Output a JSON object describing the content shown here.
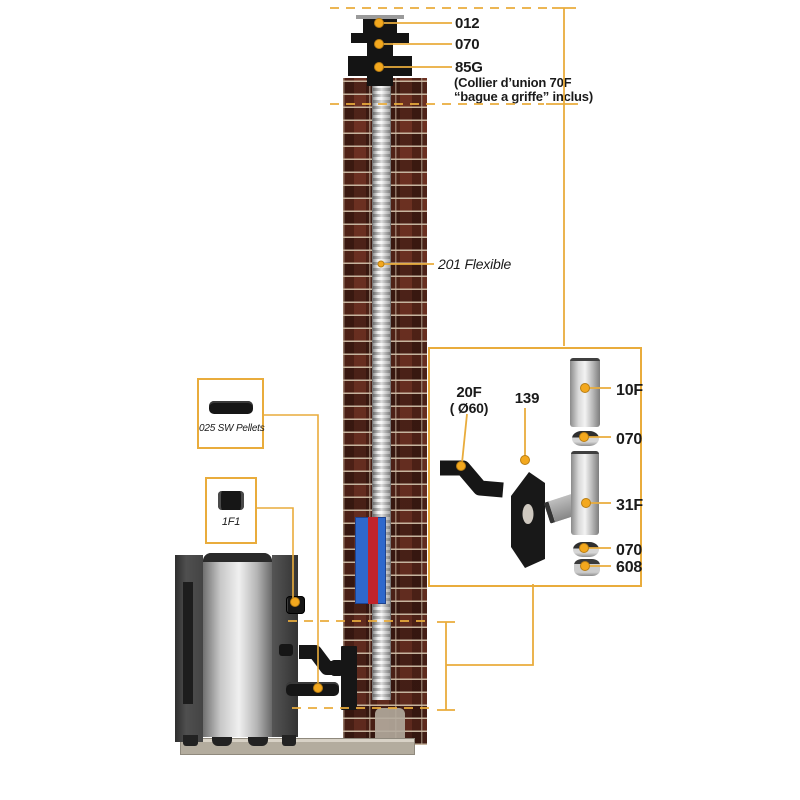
{
  "colors": {
    "accent_yellow": "#E9AC3C",
    "dot_yellow": "#F3A81E",
    "brick_red": "#773628",
    "insulation_blue": "#2E68CC",
    "insulation_red": "#C0242B",
    "label_text": "#1A1A1A"
  },
  "top_callouts": {
    "cap_label": "012",
    "collar_label": "070",
    "union_label": "85G",
    "union_note_line1": "(Collier d’union 70F",
    "union_note_line2": "“bague a griffe” inclus)"
  },
  "flex_callout": {
    "label": "201 Flexible"
  },
  "left_boxes": {
    "pellets_label": "025 SW Pellets",
    "fitting_label": "1F1"
  },
  "detail_box": {
    "elbow_label": "20F",
    "elbow_dia": "( Ø60)",
    "plate_label": "139",
    "pipe_label": "10F",
    "collar_top_label": "070",
    "tee_label": "31F",
    "collar_bottom_label": "070",
    "cap_label": "608"
  }
}
